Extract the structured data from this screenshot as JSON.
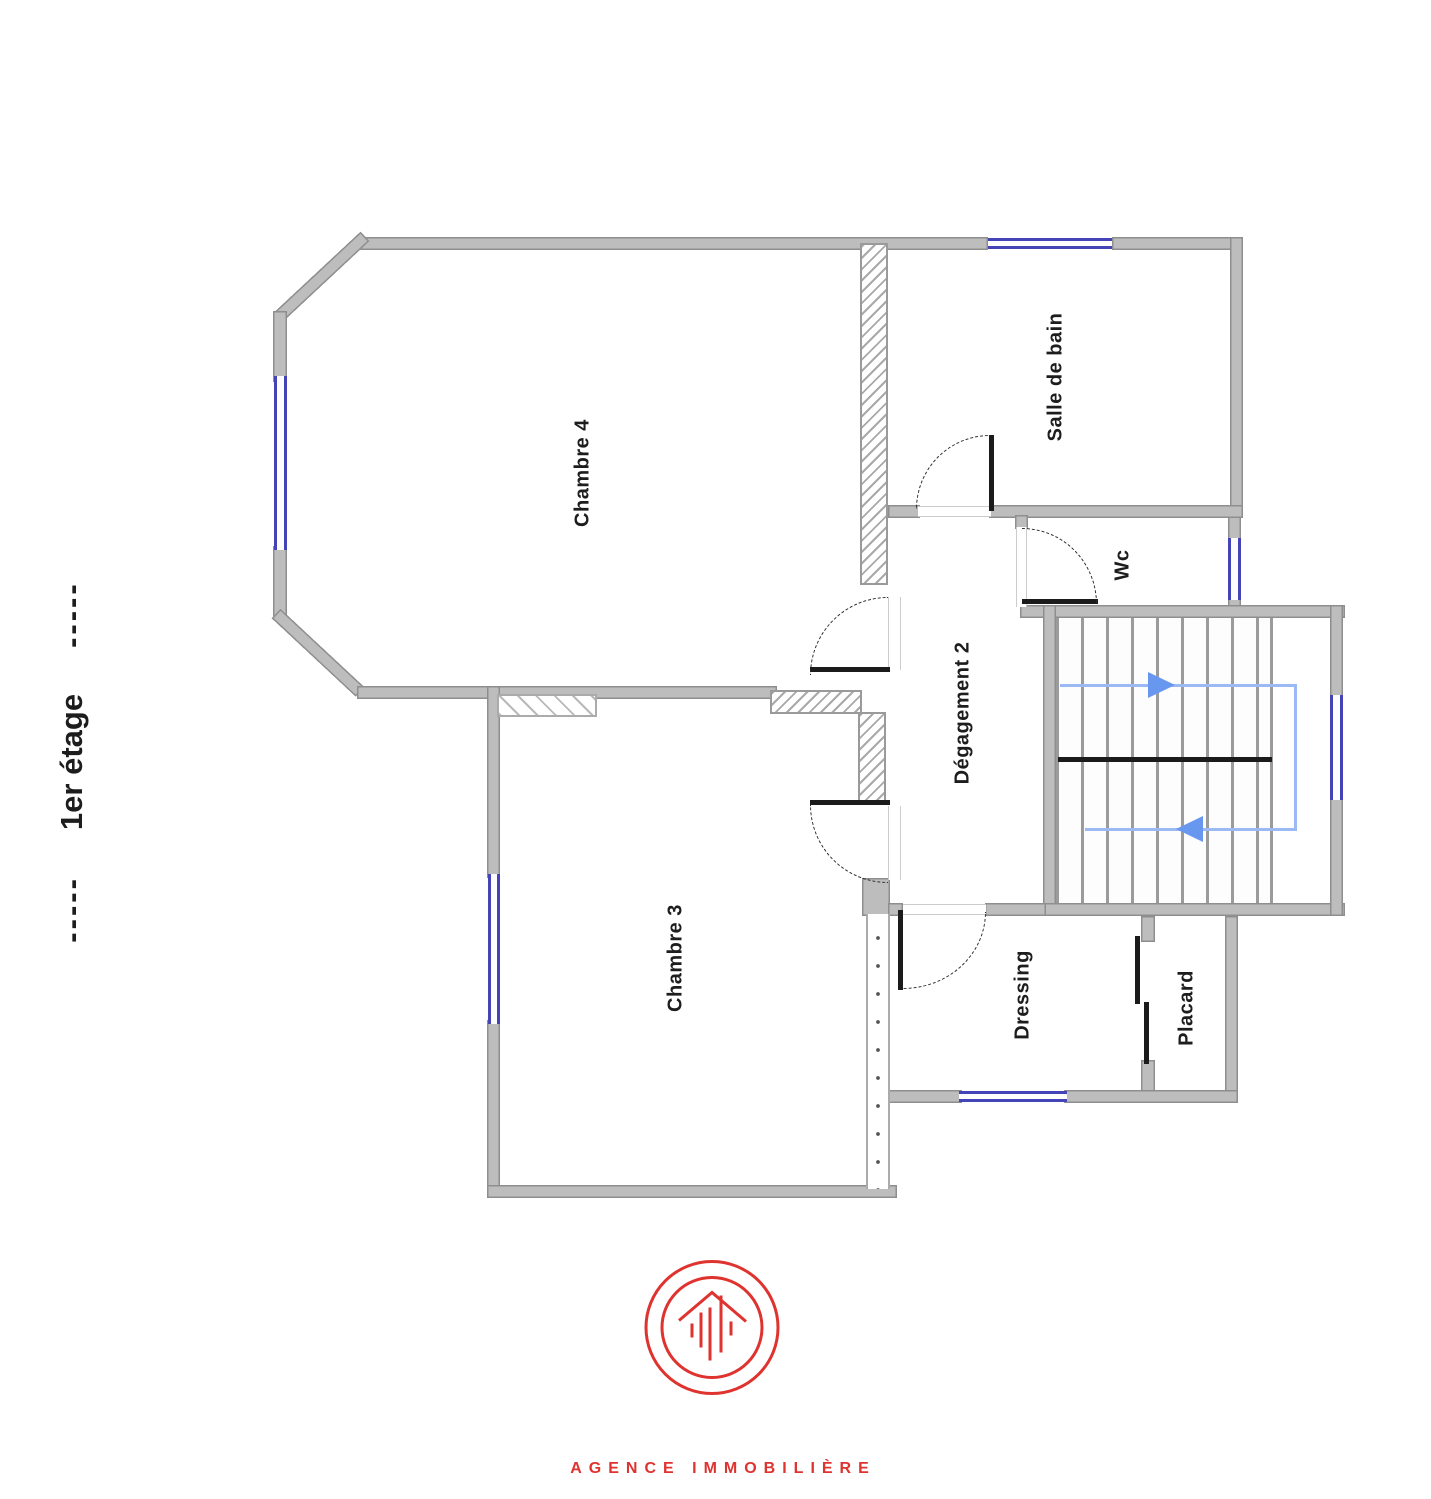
{
  "floor_header": {
    "dashes": "-----",
    "label": "1er étage"
  },
  "rooms": {
    "chambre4": {
      "label": "Chambre 4"
    },
    "salle_de_bain": {
      "label": "Salle de bain"
    },
    "wc": {
      "label": "Wc"
    },
    "degagement2": {
      "label": "Dégagement 2"
    },
    "chambre3": {
      "label": "Chambre 3"
    },
    "dressing": {
      "label": "Dressing"
    },
    "placard": {
      "label": "Placard"
    }
  },
  "footer": {
    "agency_label": "AGENCE IMMOBILIÈRE"
  },
  "icons": {
    "logo": "agency-house-logo-icon",
    "stair_up": "stair-direction-right-arrow-icon",
    "stair_down": "stair-direction-left-arrow-icon"
  },
  "colors": {
    "wall_fill": "#bdbdbd",
    "wall_edge": "#8e8e8e",
    "hatch_line": "#9a9a9a",
    "window_blue": "#4444b8",
    "stair_path": "#9bb9f3",
    "stair_arrow": "#6797ef",
    "door_black": "#1b1b1b",
    "accent_red": "#df332f",
    "text_black": "#1d1d1d",
    "threshold": "#cccccc",
    "tread_gray": "#9b9b9b",
    "background": "#ffffff"
  }
}
